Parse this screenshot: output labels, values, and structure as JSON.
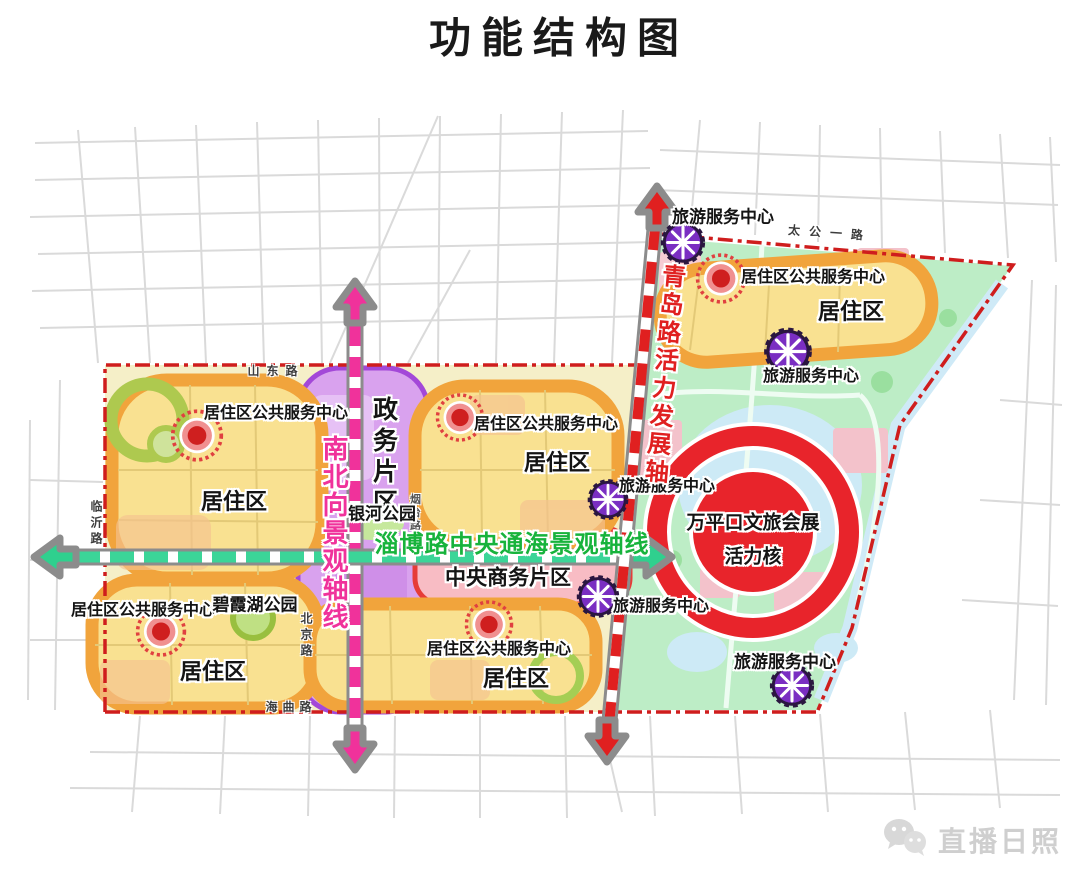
{
  "title": "功能结构图",
  "map": {
    "districts": {
      "residential": "居住区",
      "government": "政务片区",
      "cbd": "中央商务片区"
    },
    "centers": {
      "residential_service": "居住区公共服务中心",
      "tourism_service": "旅游服务中心"
    },
    "parks": {
      "galaxy": "银河公园",
      "bixia": "碧霞湖公园"
    },
    "axes": {
      "north_south": "南北向景观轴线",
      "tonghai": "淄博路中央通海景观轴线",
      "qingdao": "青岛路活力发展轴"
    },
    "core": {
      "line1": "万平口文旅会展",
      "line2": "活力核"
    },
    "roads": {
      "shandong": "山东路",
      "taigong": "太公一路",
      "linyi": "临沂路",
      "beijing": "北京路",
      "haiqu": "海曲路",
      "yantai": "烟台路"
    },
    "colors": {
      "boundary_red": "#cf1d1d",
      "axis_pink": "#f0329b",
      "axis_green": "#2fd08e",
      "axis_red": "#e02020",
      "residential_fill": "#f9e191",
      "residential_ring": "#f1a43c",
      "government_purple": "#d9a2ee",
      "cbd_pink": "#f8bcc4",
      "park_green": "#bdedc6",
      "core_red": "#e8242b",
      "tourism_purple": "#7a2ec2",
      "service_red": "#cf1f1f"
    }
  },
  "watermark": "直播日照"
}
